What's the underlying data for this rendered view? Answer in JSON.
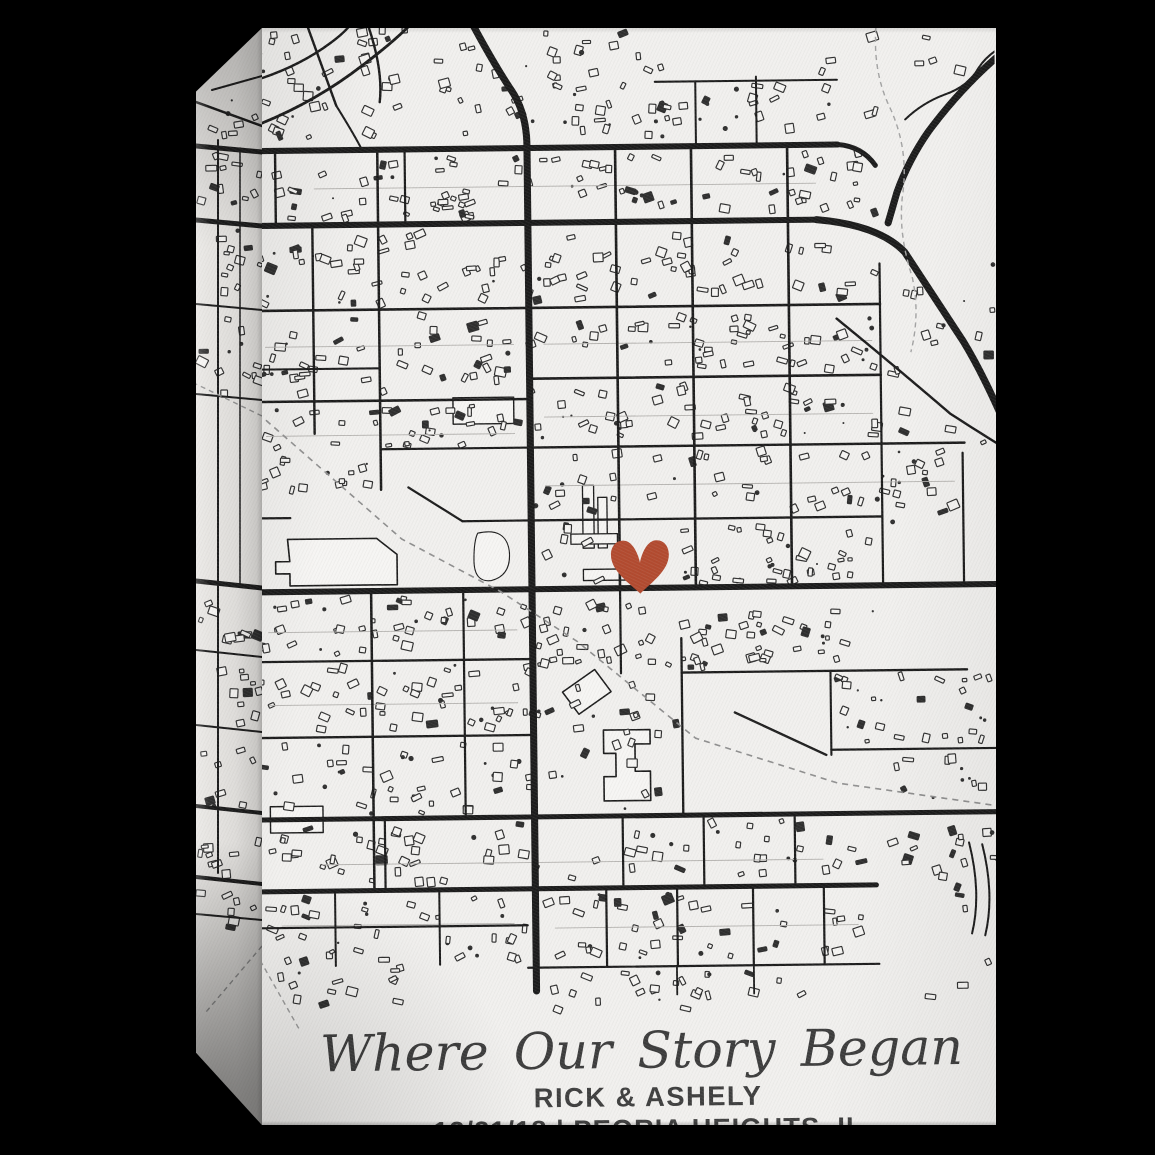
{
  "product": {
    "background_color": "#000000",
    "canvas_color": "#f1f0ee",
    "canvas_side_color": "#e7e5e2"
  },
  "overlay_text": {
    "title_script": "Where Our Story Began",
    "names": "RICK & ASHELY",
    "date_location": "12/21/18 | PEORIA HEIGHTS, IL"
  },
  "map": {
    "ink": "#1b1b1b",
    "ink2": "#2e2e2e",
    "paper": "#f6f5f3",
    "seed": 20181221,
    "heart": {
      "x": 378,
      "y": 522,
      "sx": 1.1,
      "sy": 1.28,
      "color": "#b24a2f"
    },
    "streets": [
      [
        0,
        124,
        578,
        124,
        6
      ],
      [
        0,
        198,
        560,
        198,
        6
      ],
      [
        0,
        560,
        734,
        560,
        6
      ],
      [
        0,
        785,
        734,
        785,
        5
      ],
      [
        0,
        856,
        608,
        856,
        5
      ],
      [
        398,
        60,
        578,
        60,
        2
      ],
      [
        438,
        60,
        438,
        124,
        2
      ],
      [
        498,
        56,
        498,
        124,
        2
      ],
      [
        22,
        124,
        22,
        198,
        2.4
      ],
      [
        150,
        124,
        150,
        198,
        2.2
      ],
      [
        58,
        198,
        58,
        404,
        2.4
      ],
      [
        123,
        124,
        123,
        460,
        2.5
      ],
      [
        358,
        124,
        358,
        560,
        2.6
      ],
      [
        433,
        124,
        433,
        560,
        2.6
      ],
      [
        528,
        124,
        528,
        560,
        2.6
      ],
      [
        618,
        242,
        618,
        560,
        2.2
      ],
      [
        698,
        430,
        698,
        560,
        2.2
      ],
      [
        0,
        282,
        618,
        282,
        2.6
      ],
      [
        0,
        372,
        272,
        372,
        2.5
      ],
      [
        0,
        340,
        123,
        340,
        2
      ],
      [
        123,
        420,
        272,
        420,
        2.2
      ],
      [
        272,
        352,
        618,
        352,
        2.6
      ],
      [
        272,
        420,
        700,
        420,
        2.4
      ],
      [
        272,
        492,
        618,
        492,
        2.3
      ],
      [
        203,
        492,
        272,
        492,
        2.2
      ],
      [
        0,
        487,
        33,
        487,
        2.2
      ],
      [
        0,
        629,
        272,
        629,
        2.3
      ],
      [
        0,
        704,
        272,
        704,
        2.3
      ],
      [
        112,
        560,
        112,
        854,
        2.5
      ],
      [
        203,
        560,
        203,
        785,
        2.2
      ],
      [
        358,
        560,
        358,
        644,
        2.2
      ],
      [
        418,
        610,
        418,
        785,
        2.3
      ],
      [
        418,
        644,
        700,
        644,
        2.3
      ],
      [
        565,
        645,
        565,
        727,
        2.1
      ],
      [
        565,
        722,
        734,
        722,
        2.2
      ],
      [
        123,
        785,
        123,
        856,
        2.2
      ],
      [
        358,
        785,
        358,
        856,
        2.2
      ],
      [
        438,
        785,
        438,
        856,
        2.2
      ],
      [
        528,
        785,
        528,
        856,
        2.2
      ],
      [
        73,
        856,
        73,
        930,
        2
      ],
      [
        176,
        856,
        176,
        930,
        2
      ],
      [
        341,
        856,
        341,
        934,
        2.2
      ],
      [
        411,
        856,
        411,
        934,
        2.2
      ],
      [
        486,
        856,
        486,
        934,
        2.2
      ],
      [
        556,
        856,
        556,
        934,
        2.2
      ],
      [
        263,
        934,
        610,
        934,
        2.2
      ],
      [
        0,
        892,
        263,
        892,
        2.2
      ],
      [
        410,
        934,
        410,
        962,
        1.8
      ],
      [
        486,
        934,
        486,
        962,
        1.8
      ]
    ],
    "roads": [
      {
        "d": "M 218,0 Q 240,42 257,68 Q 271,90 271,122 L 271,957",
        "w": 7
      },
      {
        "d": "M 738,38 Q 700,70 668,112 Q 648,140 636,172 L 627,202",
        "w": 7
      },
      {
        "d": "M 556,198 Q 618,204 643,231 L 700,320 Q 719,352 740,402",
        "w": 7
      },
      {
        "d": "M 575,296 Q 636,347 686,391 Q 713,409 740,426",
        "w": 2.4
      },
      {
        "d": "M 645,100 Q 662,84 684,76 Q 708,68 718,50 Q 726,38 740,30",
        "w": 2
      },
      {
        "d": "M 578,124 Q 602,126 615,145",
        "w": 5
      },
      {
        "d": "M 0,100 Q 60,78 110,40 Q 140,18 158,0",
        "w": 2.8
      },
      {
        "d": "M 0,55 Q 45,42 78,18 Q 92,8 98,0",
        "w": 2.4
      },
      {
        "d": "M 55,0 L 83,80",
        "w": 2.4
      },
      {
        "d": "M 115,0 Q 130,45 126,77",
        "w": 2.4
      },
      {
        "d": "M 83,80 Q 100,108 108,124",
        "w": 2
      },
      {
        "d": "M 150,458 L 203,492",
        "w": 2.2
      },
      {
        "d": "M 470,684 L 560,727",
        "w": 2.3
      },
      {
        "d": "M 700,815 Q 712,865 702,905",
        "w": 2
      },
      {
        "d": "M 713,817 Q 725,867 715,907",
        "w": 2
      }
    ],
    "dashed": [
      {
        "d": "M 10,390 L 143,509 L 240,562 L 315,612 L 431,709 L 571,755 L 734,780",
        "w": 1.6,
        "c": "#8f8f8f",
        "da": "6 5"
      },
      {
        "d": "M 618,0 Q 612,50 630,88 Q 648,128 642,172 Q 636,210 650,255 Q 658,292 648,330",
        "w": 1.4,
        "c": "#a3a3a3",
        "da": "5 4"
      },
      {
        "d": "M -6,916 L 36,992",
        "w": 1.4,
        "c": "#9a9a9a",
        "da": "5 4"
      }
    ],
    "alleys": [
      [
        10,
        318,
        256,
        318
      ],
      [
        10,
        406,
        256,
        406
      ],
      [
        60,
        162,
        556,
        162
      ],
      [
        285,
        318,
        610,
        318
      ],
      [
        285,
        390,
        610,
        390
      ],
      [
        285,
        458,
        690,
        458
      ],
      [
        10,
        600,
        256,
        600
      ],
      [
        10,
        672,
        256,
        672
      ],
      [
        60,
        830,
        556,
        830
      ],
      [
        20,
        890,
        250,
        890
      ],
      [
        290,
        895,
        590,
        895
      ]
    ],
    "large_buildings": [
      {
        "d": "M30,508 L118,508 L138,524 L138,554 L32,554 L32,542 L18,542 L18,530 L32,530 Z",
        "w": 1.6
      },
      {
        "d": "M218,504 Q246,498 249,522 Q251,546 231,551 Q214,553 214,531 Q214,512 218,504 Z",
        "w": 1.1
      },
      {
        "d": "M340,700 L386,700 L386,714 L371,714 L371,741 L386,741 L386,770 L340,770 L340,746 L352,746 L352,723 L340,723 Z",
        "w": 1.6
      },
      {
        "d": "M300,662 L332,640 L348,662 L316,684 Z",
        "w": 1.5
      },
      {
        "d": "M195,370 h60 v26 h-60 Z",
        "w": 1.4
      },
      {
        "d": "M322,458 h11 v62 h-11 Z",
        "w": 1.3
      },
      {
        "d": "M337,470 h9 v50 h-9 Z",
        "w": 1.3
      },
      {
        "d": "M310,506 h46 v10 h-46 Z",
        "w": 1.3
      },
      {
        "d": "M322,541 h52 v11 h-52 Z",
        "w": 1.3
      },
      {
        "d": "M10,772 h52 v26 h-52 Z",
        "w": 1.4
      }
    ],
    "building_zones": [
      [
        0,
        4,
        225,
        112,
        52
      ],
      [
        240,
        8,
        165,
        108,
        40
      ],
      [
        398,
        64,
        178,
        54,
        24
      ],
      [
        560,
        8,
        168,
        88,
        9
      ],
      [
        0,
        132,
        615,
        60,
        92
      ],
      [
        0,
        206,
        270,
        70,
        46
      ],
      [
        272,
        212,
        342,
        64,
        50
      ],
      [
        0,
        288,
        270,
        78,
        44
      ],
      [
        272,
        288,
        342,
        58,
        52
      ],
      [
        0,
        378,
        268,
        40,
        32
      ],
      [
        272,
        358,
        342,
        56,
        50
      ],
      [
        272,
        426,
        420,
        60,
        48
      ],
      [
        0,
        428,
        128,
        32,
        15
      ],
      [
        620,
        242,
        112,
        306,
        25
      ],
      [
        283,
        498,
        64,
        56,
        7
      ],
      [
        420,
        498,
        192,
        58,
        38
      ],
      [
        0,
        568,
        268,
        56,
        40
      ],
      [
        0,
        634,
        268,
        64,
        45
      ],
      [
        272,
        572,
        140,
        66,
        28
      ],
      [
        418,
        582,
        194,
        58,
        40
      ],
      [
        0,
        710,
        268,
        70,
        42
      ],
      [
        272,
        652,
        140,
        128,
        24
      ],
      [
        565,
        650,
        162,
        66,
        28
      ],
      [
        620,
        730,
        110,
        52,
        11
      ],
      [
        0,
        792,
        600,
        58,
        68
      ],
      [
        602,
        792,
        130,
        56,
        13
      ],
      [
        0,
        862,
        260,
        64,
        38
      ],
      [
        278,
        862,
        316,
        66,
        44
      ],
      [
        0,
        932,
        140,
        42,
        13
      ],
      [
        278,
        938,
        258,
        38,
        24
      ],
      [
        622,
        808,
        108,
        162,
        9
      ]
    ]
  },
  "side": {
    "bg": "#e7e5e2",
    "lines": [
      [
        66,
        124,
        0,
        118,
        5
      ],
      [
        66,
        198,
        0,
        192,
        5
      ],
      [
        66,
        282,
        0,
        276,
        2
      ],
      [
        66,
        372,
        0,
        366,
        2
      ],
      [
        66,
        560,
        0,
        553,
        5
      ],
      [
        66,
        629,
        0,
        622,
        2
      ],
      [
        66,
        704,
        0,
        697,
        2
      ],
      [
        66,
        785,
        0,
        778,
        4
      ],
      [
        66,
        856,
        0,
        849,
        4
      ],
      [
        66,
        892,
        0,
        886,
        2
      ],
      [
        22,
        112,
        22,
        845,
        2
      ],
      [
        44,
        120,
        44,
        556,
        1.5
      ],
      [
        66,
        98,
        0,
        74,
        2.5
      ],
      [
        66,
        48,
        16,
        62,
        2
      ]
    ],
    "dashed": [
      [
        66,
        388,
        0,
        356
      ],
      [
        66,
        918,
        10,
        984
      ]
    ],
    "zones": [
      [
        4,
        72,
        60,
        44,
        7
      ],
      [
        4,
        128,
        60,
        64,
        12
      ],
      [
        4,
        200,
        60,
        74,
        11
      ],
      [
        4,
        286,
        60,
        82,
        12
      ],
      [
        4,
        566,
        60,
        58,
        10
      ],
      [
        4,
        636,
        60,
        62,
        10
      ],
      [
        4,
        712,
        60,
        66,
        8
      ],
      [
        4,
        796,
        60,
        54,
        9
      ],
      [
        4,
        860,
        60,
        46,
        7
      ]
    ]
  }
}
